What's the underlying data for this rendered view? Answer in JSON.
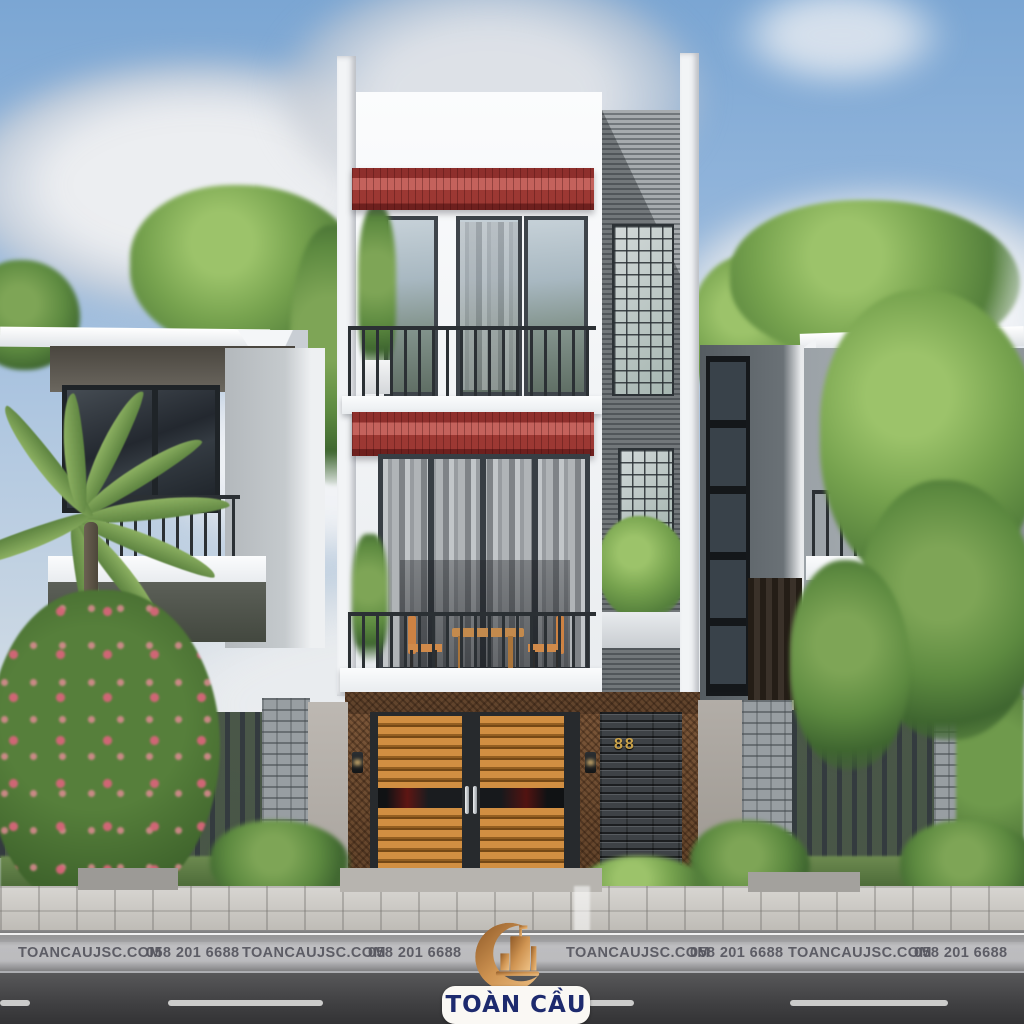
{
  "scene_title": "Modern 3-storey townhouse exterior rendering",
  "house": {
    "number": "88"
  },
  "watermark": {
    "items": [
      "TOANCAUJSC.COM",
      "058 201 6688",
      "TOANCAUJSC.COM",
      "058 201 6688",
      "TOANCAUJSC.COM",
      "058 201 6688",
      "TOANCAUJSC.COM",
      "058 201 6688"
    ]
  },
  "logo": {
    "brand": "TOÀN CẦU"
  },
  "colors": {
    "awning_red": "#9c3833",
    "logo_copper": "#c98c4e",
    "logo_navy": "#1d2a6e",
    "house_number_gold": "#c9a24a",
    "sky_blue": "#7ba6d3"
  }
}
